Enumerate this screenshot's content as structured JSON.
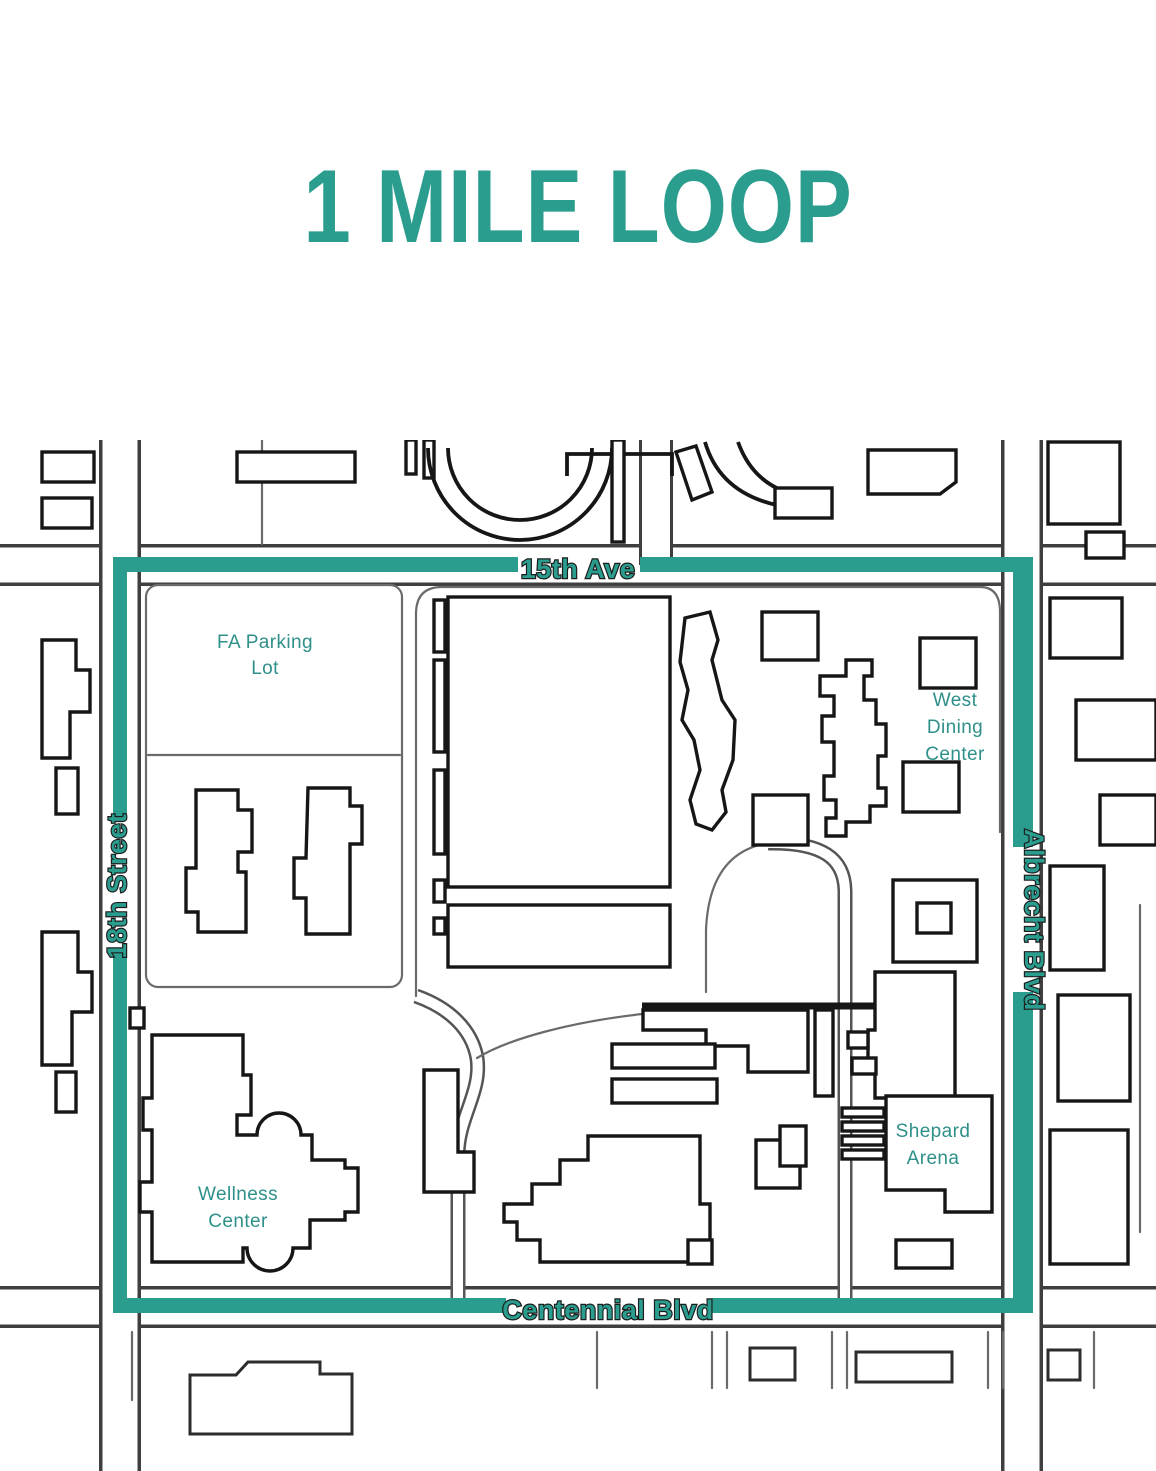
{
  "title": "1 MILE LOOP",
  "colors": {
    "accent": "#2a9d8f",
    "route": "#2a9d8f",
    "building_line": "#161616",
    "road_line": "#3f3f3f",
    "place_label": "#2e9089"
  },
  "map": {
    "streets": [
      {
        "id": "15th-ave",
        "label": "15th Ave"
      },
      {
        "id": "18th-street",
        "label": "18th Street"
      },
      {
        "id": "albrecht-blvd",
        "label": "Albrecht Blvd"
      },
      {
        "id": "centennial-blvd",
        "label": "Centennial Blvd"
      }
    ],
    "places": [
      {
        "id": "fa-parking-lot",
        "lines": [
          "FA Parking",
          "Lot"
        ]
      },
      {
        "id": "west-dining-center",
        "lines": [
          "West",
          "Dining",
          "Center"
        ]
      },
      {
        "id": "shepard-arena",
        "lines": [
          "Shepard",
          "Arena"
        ]
      },
      {
        "id": "wellness-center",
        "lines": [
          "Wellness",
          "Center"
        ]
      }
    ]
  }
}
